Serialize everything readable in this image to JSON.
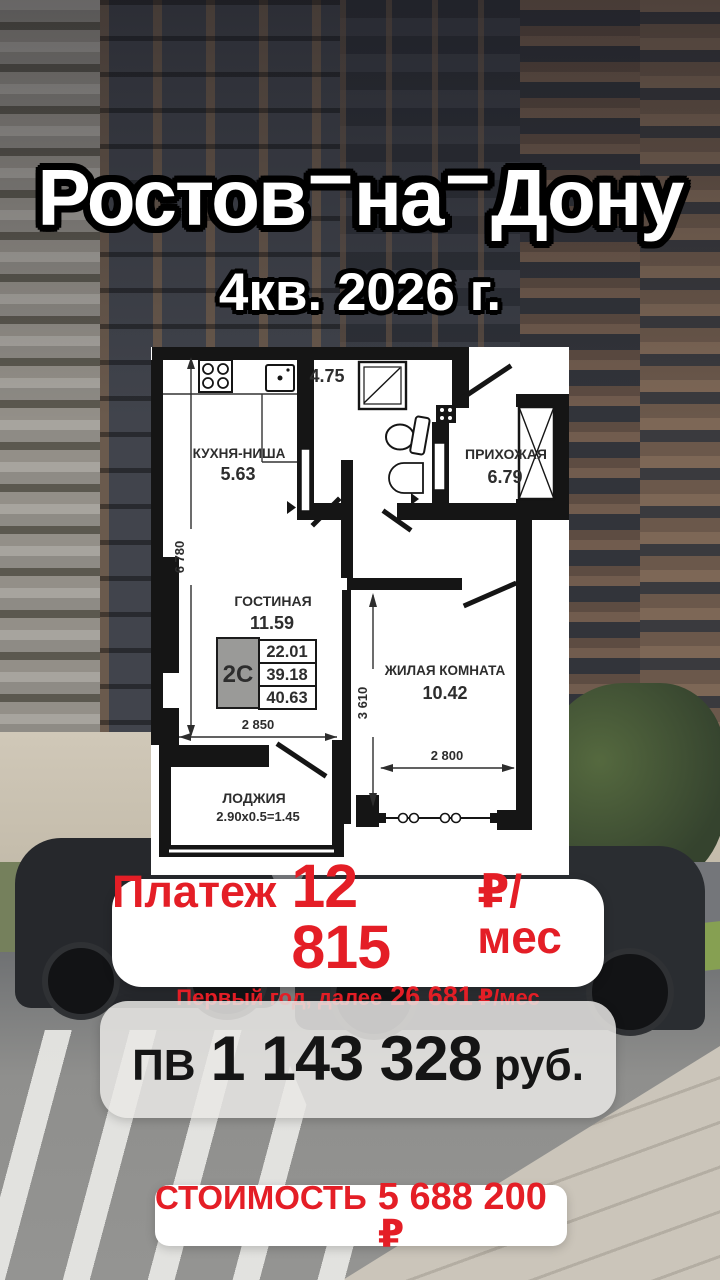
{
  "header": {
    "title_parts": [
      "Ростов",
      "на",
      "Дону"
    ],
    "title_separator": "–",
    "subtitle": "4кв. 2026 г."
  },
  "floorplan": {
    "kitchen_name": "КУХНЯ-НИША",
    "kitchen_area": "5.63",
    "bathroom_area": "4.75",
    "hallway_name": "ПРИХОЖАЯ",
    "hallway_area": "6.79",
    "living_name": "ГОСТИНАЯ",
    "living_area": "11.59",
    "bedroom_name": "ЖИЛАЯ КОМНАТА",
    "bedroom_area": "10.42",
    "loggia_name": "ЛОДЖИЯ",
    "loggia_area": "2.90х0.5=1.45",
    "unit_type": "2С",
    "unit_table": [
      "22.01",
      "39.18",
      "40.63"
    ],
    "dim_height_total": "6 780",
    "dim_living_width": "2 850",
    "dim_bedroom_height": "3 610",
    "dim_bedroom_width": "2 800"
  },
  "offers": {
    "payment_label": "Платеж",
    "payment_value": "12 815",
    "payment_unit": "₽/мес",
    "payment_note_prefix": "Первый год, далее",
    "payment_note_value": "26 681",
    "payment_note_unit": "₽/мес",
    "downpayment_label": "ПВ",
    "downpayment_value": "1 143 328",
    "downpayment_unit": "руб.",
    "price_label": "СТОИМОСТЬ",
    "price_value": "5 688 200 ₽"
  },
  "colors": {
    "accent_red": "#e41e26",
    "text_dark": "#151515",
    "plan_wall": "#151515",
    "card_white": "#ffffff"
  }
}
